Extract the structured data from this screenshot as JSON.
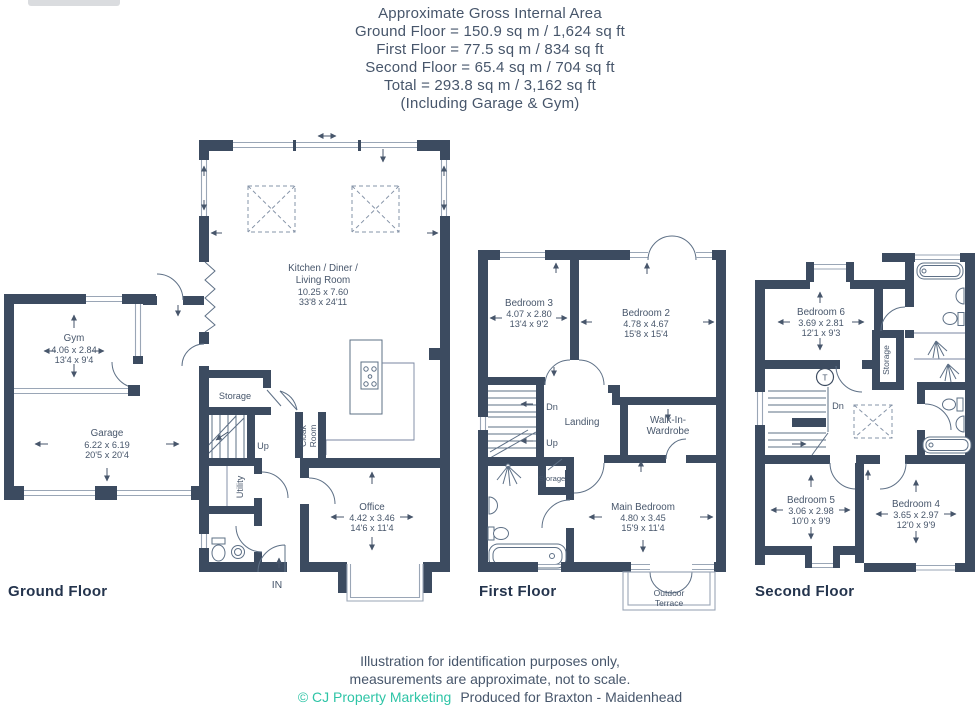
{
  "colors": {
    "wall": "#3C4B60",
    "thin_line": "#5E7086",
    "window_line": "#9AA6B6",
    "text": "#47566B",
    "title": "#24344D",
    "teal": "#2EC4A6"
  },
  "header": {
    "title": "Approximate Gross Internal Area",
    "ground": "Ground Floor = 150.9 sq m / 1,624 sq ft",
    "first": "First Floor = 77.5 sq m / 834 sq ft",
    "second": "Second Floor = 65.4 sq m / 704 sq ft",
    "total": "Total = 293.8 sq m / 3,162 sq ft",
    "including": "(Including Garage & Gym)"
  },
  "floors": {
    "ground": {
      "title": "Ground Floor",
      "rooms": {
        "kitchen": {
          "line1": "Kitchen / Diner /",
          "line2": "Living Room",
          "metric": "10.25 x 7.60",
          "imperial": "33'8 x 24'11"
        },
        "gym": {
          "name": "Gym",
          "metric": "4.06 x 2.84",
          "imperial": "13'4 x 9'4"
        },
        "garage": {
          "name": "Garage",
          "metric": "6.22 x 6.19",
          "imperial": "20'5 x 20'4"
        },
        "office": {
          "name": "Office",
          "metric": "4.42 x 3.46",
          "imperial": "14'6 x 11'4"
        },
        "storage": {
          "name": "Storage"
        },
        "utility": {
          "name": "Utility"
        },
        "cloak": {
          "line1": "Cloak",
          "line2": "Room"
        },
        "stairs": {
          "up": "Up"
        },
        "entrance": {
          "label": "IN"
        }
      }
    },
    "first": {
      "title": "First Floor",
      "rooms": {
        "bedroom3": {
          "name": "Bedroom 3",
          "metric": "4.07 x 2.80",
          "imperial": "13'4 x 9'2"
        },
        "bedroom2": {
          "name": "Bedroom 2",
          "metric": "4.78 x 4.67",
          "imperial": "15'8 x 15'4"
        },
        "main": {
          "name": "Main Bedroom",
          "metric": "4.80 x 3.45",
          "imperial": "15'9 x 11'4"
        },
        "landing": {
          "name": "Landing"
        },
        "walkin": {
          "line1": "Walk-In-",
          "line2": "Wardrobe"
        },
        "storage": {
          "name": "Storage"
        },
        "stairs": {
          "dn": "Dn",
          "up": "Up"
        },
        "terrace": {
          "line1": "Outdoor",
          "line2": "Terrace"
        }
      }
    },
    "second": {
      "title": "Second Floor",
      "rooms": {
        "bedroom6": {
          "name": "Bedroom 6",
          "metric": "3.69 x 2.81",
          "imperial": "12'1 x 9'3"
        },
        "bedroom5": {
          "name": "Bedroom 5",
          "metric": "3.06 x 2.98",
          "imperial": "10'0 x 9'9"
        },
        "bedroom4": {
          "name": "Bedroom 4",
          "metric": "3.65 x 2.97",
          "imperial": "12'0 x 9'9"
        },
        "storage": {
          "name": "Storage"
        },
        "stairs": {
          "dn": "Dn"
        },
        "tank": {
          "label": "T"
        }
      }
    }
  },
  "footer": {
    "line1": "Illustration for identification purposes only,",
    "line2": "measurements are approximate, not to scale.",
    "credit": "© CJ Property Marketing",
    "produced": "Produced for Braxton - Maidenhead"
  }
}
